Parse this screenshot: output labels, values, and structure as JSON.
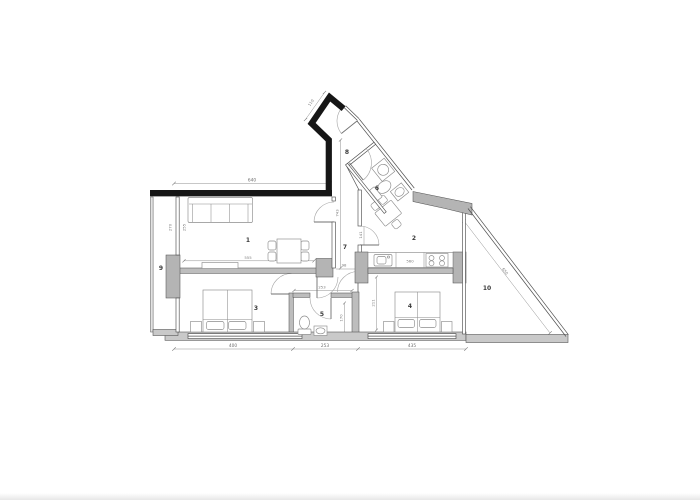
{
  "page": {
    "background": "#ffffff",
    "footer_strip_color": "#e7e7e7"
  },
  "floorplan": {
    "room_labels": {
      "living": "1",
      "kitchen": "2",
      "bedroom_a": "3",
      "bedroom_b": "4",
      "bathroom_small": "5",
      "bathroom_entry": "6",
      "hallway": "7",
      "entry": "8",
      "balcony": "9",
      "terrace": "10"
    },
    "dimensions": {
      "top_width": "640",
      "bottom_left": "400",
      "bottom_middle": "253",
      "bottom_right": "435",
      "entry_door": "110",
      "terrace_diagonal": "650",
      "living_sideboard": "555",
      "kitchen_counter": "560",
      "hall_width": "98",
      "hall_length": "743",
      "vestibule_width": "253",
      "bathroom_width": "170",
      "bedroom_b_depth": "211",
      "kitchen_door": "141",
      "balcony_side_a": "270",
      "balcony_side_b": "255"
    },
    "colors": {
      "exterior_wall": "#161616",
      "masonry_fill": "#bdbdbd",
      "line": "#4f4f4f"
    }
  }
}
